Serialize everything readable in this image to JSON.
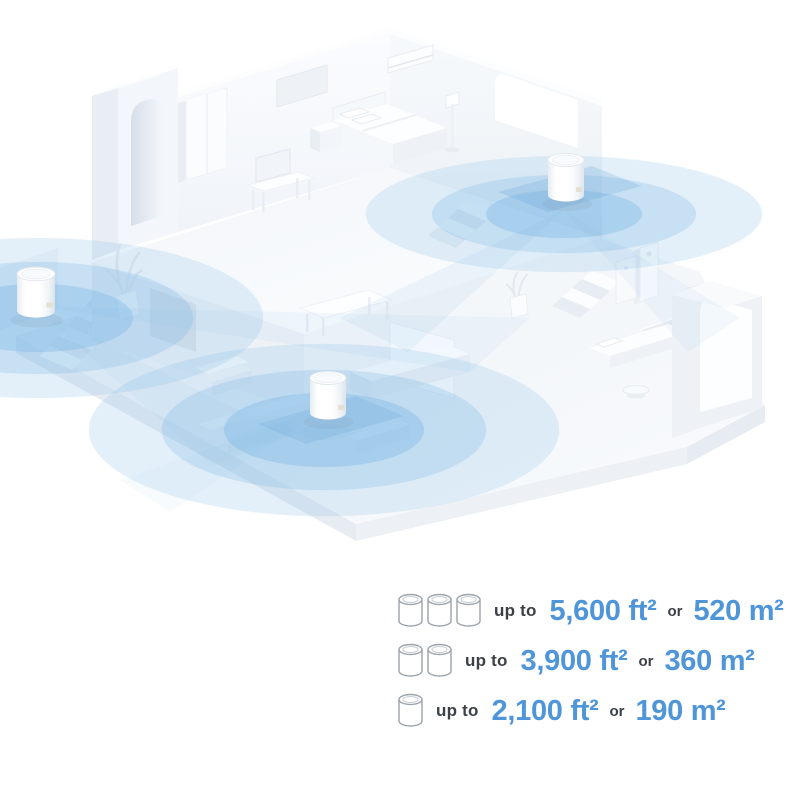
{
  "page": {
    "background_color": "#ffffff",
    "width": 800,
    "height": 800
  },
  "illustration": {
    "type": "isometric-home-wifi-coverage",
    "description": "Isometric two-story home with three mesh Wi-Fi units broadcasting blue coverage circles",
    "coverage_color": "#7db9e6",
    "structure_color": "#f3f6fa",
    "units": [
      {
        "id": "upper-floor-unit",
        "location": "upper floor"
      },
      {
        "id": "left-room-unit",
        "location": "left room"
      },
      {
        "id": "living-room-unit",
        "location": "living room"
      }
    ]
  },
  "legend": {
    "text_color": "#3c4047",
    "accent_color": "#4f95d9",
    "rows": [
      {
        "unit_count": 3,
        "prefix": "up to",
        "imperial": "5,600 ft²",
        "conjunction": "or",
        "metric": "520 m²"
      },
      {
        "unit_count": 2,
        "prefix": "up to",
        "imperial": "3,900 ft²",
        "conjunction": "or",
        "metric": "360 m²"
      },
      {
        "unit_count": 1,
        "prefix": "up to",
        "imperial": "2,100 ft²",
        "conjunction": "or",
        "metric": "190 m²"
      }
    ]
  }
}
